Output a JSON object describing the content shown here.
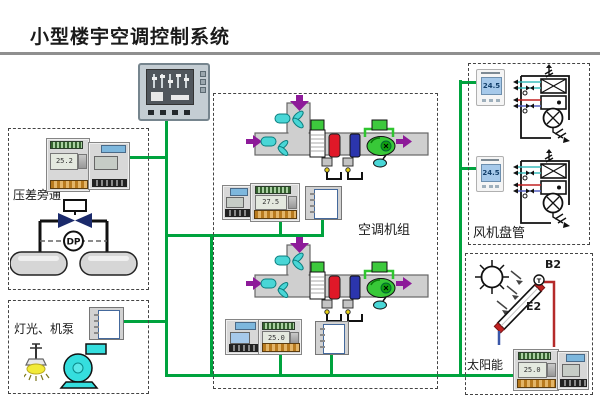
{
  "title": "小型楼宇空调控制系统",
  "colors": {
    "network_green": "#00a33e",
    "pipe_red": "#b52a2a",
    "pipe_blue": "#3a57a8"
  },
  "pressure_bypass": {
    "label": "压差旁通",
    "dp_label": "DP",
    "controller_lcd": "25.2"
  },
  "lighting_pump": {
    "label": "灯光、机泵"
  },
  "ahu": {
    "label": "空调机组",
    "upper_controller_lcd": "27.5",
    "lower_controller_lcd": "25.0"
  },
  "fan_coil": {
    "label": "风机盘管",
    "thermostat1_value": "24.5",
    "thermostat2_value": "24.5"
  },
  "solar": {
    "label": "太阳能",
    "b2_label": "B2",
    "e2_label": "E2",
    "sensor_label": "T",
    "controller_lcd": "25.0"
  }
}
